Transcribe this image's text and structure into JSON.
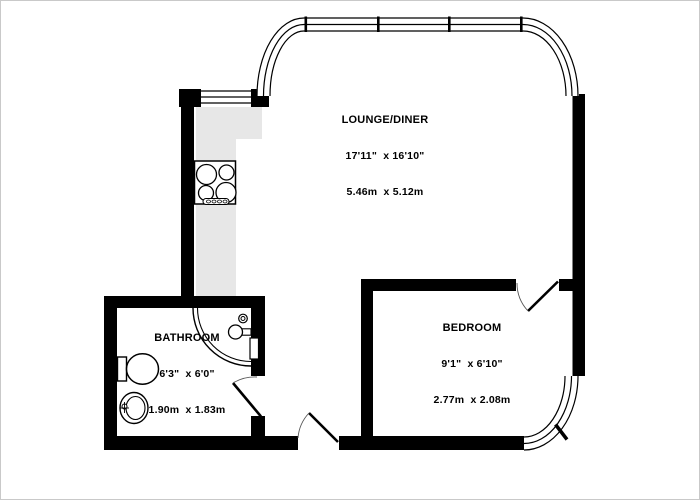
{
  "floorplan": {
    "rooms": [
      {
        "name": "LOUNGE/DINER",
        "imperial": "17'11\"  x 16'10\"",
        "metric": "5.46m  x 5.12m"
      },
      {
        "name": "BEDROOM",
        "imperial": "9'1\"  x 6'10\"",
        "metric": "2.77m  x 2.08m"
      },
      {
        "name": "BATHROOM",
        "imperial": "6'3\"  x 6'0\"",
        "metric": "1.90m  x 1.83m"
      }
    ],
    "colors": {
      "wall": "#000000",
      "counter": "#e7e7e7",
      "background": "#ffffff",
      "line": "#000000"
    }
  }
}
